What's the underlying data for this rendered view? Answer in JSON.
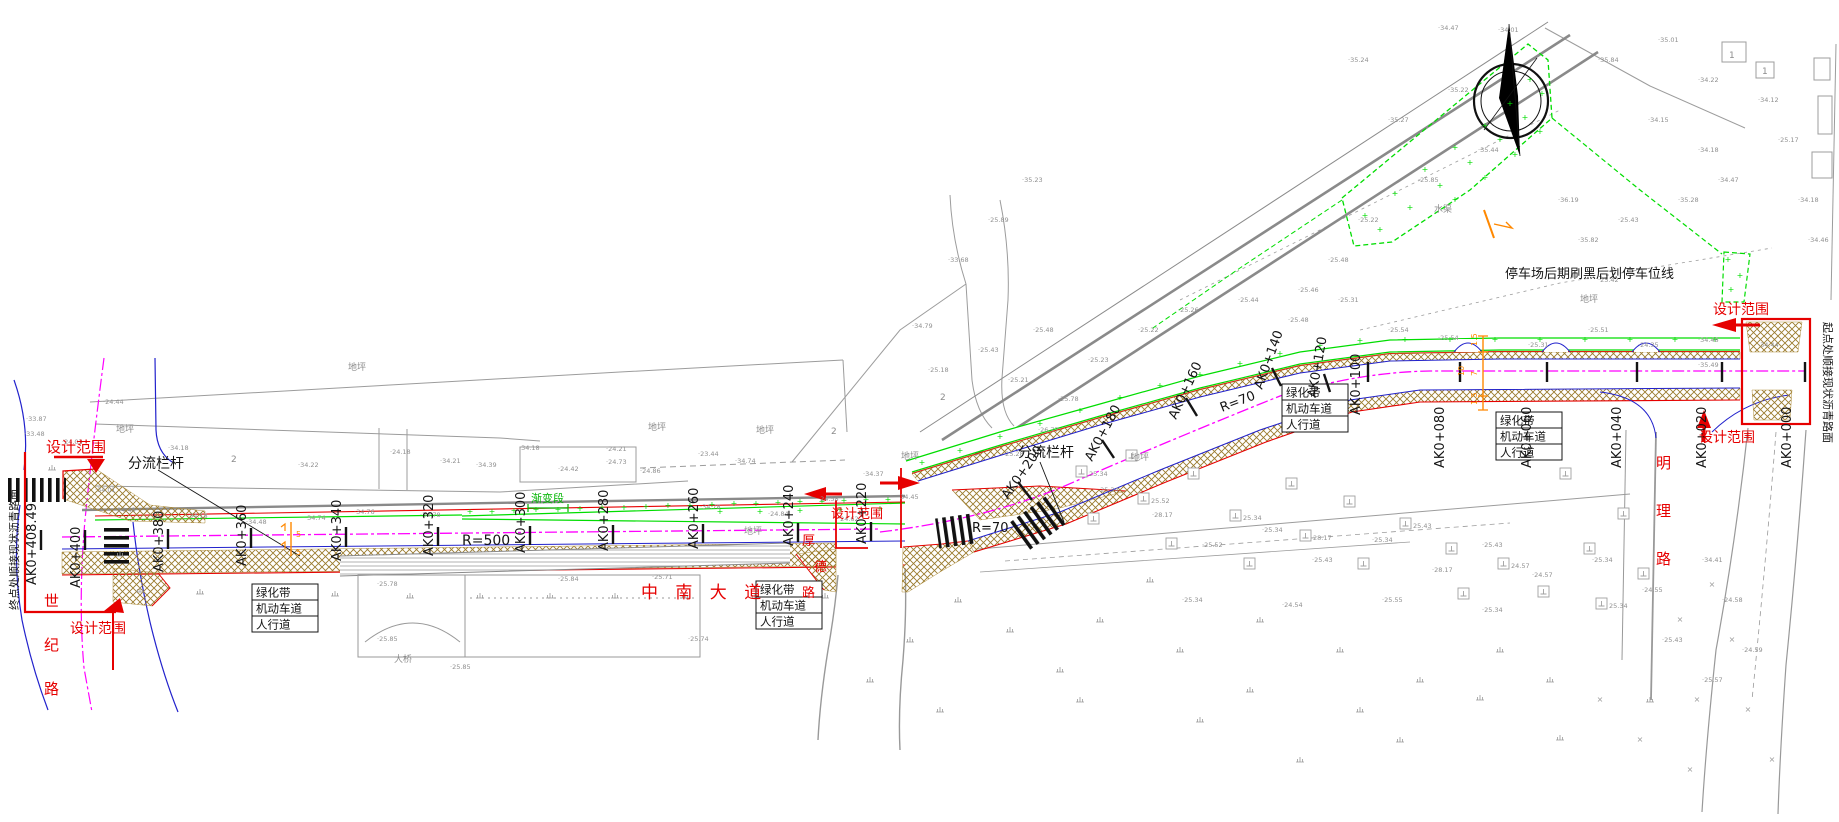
{
  "colors": {
    "red": "#e60000",
    "black": "#141414",
    "green": "#00b400",
    "bright_green": "#00dd00",
    "gray": "#8c8c8c",
    "magenta": "#ff00ff",
    "blue": "#2222cc",
    "hatch_brown": "#9a7b2d",
    "orange": "#ff8800"
  },
  "labels": {
    "red": [
      {
        "t": "设计范围",
        "x": 46,
        "y": 452,
        "s": 15,
        "n": "design-scope-label"
      },
      {
        "t": "设计范围",
        "x": 70,
        "y": 633,
        "s": 14,
        "n": "design-scope-label"
      },
      {
        "t": "设计范围",
        "x": 831,
        "y": 518,
        "s": 13,
        "n": "design-scope-label"
      },
      {
        "t": "设计范围",
        "x": 1713,
        "y": 314,
        "s": 14,
        "n": "design-scope-label"
      },
      {
        "t": "设计范围",
        "x": 1699,
        "y": 442,
        "s": 14,
        "n": "design-scope-label"
      },
      {
        "t": "中 南 大 道",
        "x": 641,
        "y": 598,
        "s": 17,
        "ls": 6,
        "n": "road-name-zhongnan-avenue"
      },
      {
        "t": "明",
        "x": 1656,
        "y": 468,
        "s": 15,
        "n": "road-name-mingli"
      },
      {
        "t": "理",
        "x": 1656,
        "y": 516,
        "s": 15,
        "n": "road-name-mingli"
      },
      {
        "t": "路",
        "x": 1656,
        "y": 564,
        "s": 15,
        "n": "road-name-mingli"
      },
      {
        "t": "世",
        "x": 44,
        "y": 606,
        "s": 15,
        "n": "road-name-shiji"
      },
      {
        "t": "纪",
        "x": 44,
        "y": 650,
        "s": 15,
        "n": "road-name-shiji"
      },
      {
        "t": "路",
        "x": 44,
        "y": 694,
        "s": 15,
        "n": "road-name-shiji"
      },
      {
        "t": "厚",
        "x": 802,
        "y": 545,
        "s": 13,
        "n": "road-name-houde"
      },
      {
        "t": "德",
        "x": 814,
        "y": 571,
        "s": 13,
        "n": "road-name-houde"
      },
      {
        "t": "路",
        "x": 802,
        "y": 597,
        "s": 13,
        "n": "road-name-houde"
      }
    ],
    "black": [
      {
        "t": "分流栏杆",
        "x": 128,
        "y": 468,
        "s": 14,
        "n": "diversion-railing-label"
      },
      {
        "t": "分流栏杆",
        "x": 1018,
        "y": 457,
        "s": 14,
        "n": "diversion-railing-label"
      },
      {
        "t": "停车场后期刷黑后划停车位线",
        "x": 1505,
        "y": 278,
        "s": 13,
        "n": "parking-note-label"
      },
      {
        "t": "起点处顺接现状沥青路面",
        "x": 1824,
        "y": 322,
        "s": 11,
        "r": 90,
        "n": "start-point-note"
      },
      {
        "t": "终点处顺接现状沥青路面",
        "x": 18,
        "y": 610,
        "s": 11,
        "r": -90,
        "n": "end-point-note"
      },
      {
        "t": "R=500",
        "x": 462,
        "y": 545,
        "s": 14,
        "n": "radius-label"
      },
      {
        "t": "R=70",
        "x": 972,
        "y": 532,
        "s": 13,
        "n": "radius-label"
      },
      {
        "t": "R=70",
        "x": 1222,
        "y": 412,
        "s": 13,
        "r": -21,
        "n": "radius-label"
      }
    ],
    "green": [
      {
        "t": "渐变段",
        "x": 531,
        "y": 502,
        "s": 11,
        "n": "transition-section-label"
      }
    ],
    "gray": [
      {
        "t": "地坪",
        "x": 116,
        "y": 432
      },
      {
        "t": "地坪",
        "x": 648,
        "y": 430
      },
      {
        "t": "地坪",
        "x": 756,
        "y": 433
      },
      {
        "t": "地坪",
        "x": 901,
        "y": 459
      },
      {
        "t": "地坪",
        "x": 1131,
        "y": 460
      },
      {
        "t": "地坪",
        "x": 1580,
        "y": 302
      },
      {
        "t": "地坪",
        "x": 744,
        "y": 534
      },
      {
        "t": "水渠",
        "x": 1434,
        "y": 212
      },
      {
        "t": "地坪",
        "x": 348,
        "y": 370
      },
      {
        "t": "大桥",
        "x": 394,
        "y": 662
      },
      {
        "t": "2",
        "x": 231,
        "y": 462
      },
      {
        "t": "2",
        "x": 831,
        "y": 434
      },
      {
        "t": "2",
        "x": 940,
        "y": 400
      },
      {
        "t": "1",
        "x": 1729,
        "y": 58
      },
      {
        "t": "1",
        "x": 1762,
        "y": 74
      }
    ]
  },
  "stations": [
    {
      "label": "AK0+408.49",
      "x": 36,
      "y": 585,
      "r": -90,
      "tick": [
        41,
        530,
        41,
        550
      ]
    },
    {
      "label": "AK0+400",
      "x": 80,
      "y": 588,
      "r": -90,
      "tick": [
        85,
        530,
        85,
        550
      ]
    },
    {
      "label": "AK0+380",
      "x": 163,
      "y": 572,
      "r": -90,
      "tick": [
        168,
        529,
        168,
        549
      ]
    },
    {
      "label": "AK0+360",
      "x": 246,
      "y": 566,
      "r": -90,
      "tick": [
        251,
        528,
        251,
        548
      ]
    },
    {
      "label": "AK0+340",
      "x": 341,
      "y": 561,
      "r": -90,
      "tick": [
        346,
        527,
        346,
        547
      ]
    },
    {
      "label": "AK0+320",
      "x": 433,
      "y": 556,
      "r": -90,
      "tick": [
        438,
        527,
        438,
        546
      ]
    },
    {
      "label": "AK0+300",
      "x": 525,
      "y": 553,
      "r": -90,
      "tick": [
        530,
        526,
        530,
        545
      ]
    },
    {
      "label": "AK0+280",
      "x": 608,
      "y": 551,
      "r": -90,
      "tick": [
        613,
        525,
        613,
        544
      ]
    },
    {
      "label": "AK0+260",
      "x": 698,
      "y": 549,
      "r": -90,
      "tick": [
        703,
        524,
        703,
        543
      ]
    },
    {
      "label": "AK0+240",
      "x": 793,
      "y": 546,
      "r": -90,
      "tick": [
        798,
        523,
        798,
        542
      ]
    },
    {
      "label": "AK0+220",
      "x": 866,
      "y": 544,
      "r": -90,
      "tick": [
        871,
        522,
        871,
        541
      ]
    },
    {
      "label": "AK0+200",
      "x": 1008,
      "y": 500,
      "r": -55,
      "tick": [
        1018,
        482,
        1032,
        500
      ]
    },
    {
      "label": "AK0+180",
      "x": 1092,
      "y": 462,
      "r": -62,
      "tick": [
        1102,
        440,
        1114,
        458
      ]
    },
    {
      "label": "AK0+160",
      "x": 1176,
      "y": 420,
      "r": -65,
      "tick": [
        1186,
        398,
        1197,
        416
      ]
    },
    {
      "label": "AK0+140",
      "x": 1262,
      "y": 390,
      "r": -70,
      "tick": [
        1272,
        368,
        1281,
        386
      ]
    },
    {
      "label": "AK0+120",
      "x": 1316,
      "y": 398,
      "r": -80,
      "tick": [
        1324,
        374,
        1330,
        392
      ]
    },
    {
      "label": "AK0+100",
      "x": 1360,
      "y": 415,
      "r": -90,
      "tick": [
        1368,
        362,
        1368,
        382
      ]
    },
    {
      "label": "AK0+080",
      "x": 1444,
      "y": 468,
      "r": -90,
      "tick": [
        1460,
        362,
        1460,
        382
      ]
    },
    {
      "label": "AK0+060",
      "x": 1531,
      "y": 468,
      "r": -90,
      "tick": [
        1547,
        362,
        1547,
        382
      ]
    },
    {
      "label": "AK0+040",
      "x": 1621,
      "y": 468,
      "r": -90,
      "tick": [
        1637,
        362,
        1637,
        382
      ]
    },
    {
      "label": "AK0+020",
      "x": 1706,
      "y": 468,
      "r": -90,
      "tick": [
        1722,
        362,
        1722,
        382
      ]
    },
    {
      "label": "AK0+000",
      "x": 1791,
      "y": 468,
      "r": -90,
      "tick": [
        1805,
        362,
        1805,
        382
      ]
    }
  ],
  "lane_boxes": {
    "rows": [
      "绿化带",
      "机动车道",
      "人行道"
    ],
    "boxes": [
      {
        "x": 252,
        "y": 584
      },
      {
        "x": 756,
        "y": 581
      },
      {
        "x": 1282,
        "y": 384
      },
      {
        "x": 1496,
        "y": 412
      }
    ]
  },
  "dim_stack": {
    "labels": [
      {
        "t": "1.5",
        "x": 1477,
        "y": 346
      },
      {
        "t": "7",
        "x": 1477,
        "y": 376
      },
      {
        "t": "1.5",
        "x": 1477,
        "y": 405
      },
      {
        "t": "10",
        "x": 1464,
        "y": 376
      }
    ]
  },
  "signals": [
    {
      "t": "5",
      "x": 296,
      "y": 537
    },
    {
      "t": "5",
      "x": 296,
      "y": 555
    }
  ],
  "elevations": [
    [
      103,
      404,
      "24.44"
    ],
    [
      62,
      444,
      "24.03"
    ],
    [
      26,
      421,
      "33.87"
    ],
    [
      24,
      436,
      "33.48"
    ],
    [
      95,
      492,
      "34.01"
    ],
    [
      115,
      512,
      "24.48"
    ],
    [
      168,
      450,
      "34.18"
    ],
    [
      187,
      518,
      "34.18"
    ],
    [
      246,
      524,
      "34.48"
    ],
    [
      305,
      520,
      "34.74"
    ],
    [
      354,
      514,
      "34.76"
    ],
    [
      420,
      517,
      "34.78"
    ],
    [
      298,
      467,
      "34.22"
    ],
    [
      390,
      454,
      "24.18"
    ],
    [
      440,
      463,
      "34.21"
    ],
    [
      476,
      467,
      "34.39"
    ],
    [
      519,
      450,
      "34.18"
    ],
    [
      558,
      471,
      "24.42"
    ],
    [
      606,
      451,
      "24.21"
    ],
    [
      606,
      464,
      "24.73"
    ],
    [
      640,
      473,
      "24.86"
    ],
    [
      698,
      456,
      "23.44"
    ],
    [
      735,
      463,
      "34.74"
    ],
    [
      700,
      509,
      "34.78"
    ],
    [
      768,
      516,
      "24.84"
    ],
    [
      818,
      501,
      "24.58"
    ],
    [
      838,
      521,
      "24.62"
    ],
    [
      863,
      476,
      "34.37"
    ],
    [
      898,
      499,
      "34.45"
    ],
    [
      377,
      586,
      "25.78"
    ],
    [
      558,
      581,
      "25.84"
    ],
    [
      652,
      579,
      "25.71"
    ],
    [
      377,
      641,
      "25.85"
    ],
    [
      688,
      641,
      "25.74"
    ],
    [
      450,
      669,
      "25.85"
    ],
    [
      1003,
      456,
      "25.28"
    ],
    [
      1038,
      432,
      "26.77"
    ],
    [
      1058,
      401,
      "25.78"
    ],
    [
      1008,
      382,
      "25.21"
    ],
    [
      978,
      352,
      "25.43"
    ],
    [
      1033,
      332,
      "25.48"
    ],
    [
      1088,
      362,
      "25.23"
    ],
    [
      1138,
      332,
      "25.22"
    ],
    [
      1178,
      312,
      "25.26"
    ],
    [
      1238,
      302,
      "25.44"
    ],
    [
      1288,
      322,
      "25.48"
    ],
    [
      1338,
      302,
      "25.31"
    ],
    [
      1388,
      332,
      "25.54"
    ],
    [
      1438,
      340,
      "25.54"
    ],
    [
      1528,
      347,
      "25.31"
    ],
    [
      1588,
      332,
      "25.51"
    ],
    [
      1638,
      347,
      "24.35"
    ],
    [
      1698,
      342,
      "34.48"
    ],
    [
      1758,
      347,
      "34.44"
    ],
    [
      1698,
      367,
      "35.49"
    ],
    [
      1098,
      492,
      "25.34"
    ],
    [
      1152,
      517,
      "28.17"
    ],
    [
      1202,
      547,
      "25.52"
    ],
    [
      1262,
      532,
      "25.34"
    ],
    [
      1312,
      562,
      "25.43"
    ],
    [
      1372,
      542,
      "25.34"
    ],
    [
      1432,
      572,
      "28.17"
    ],
    [
      1482,
      547,
      "25.43"
    ],
    [
      1532,
      577,
      "24.57"
    ],
    [
      1592,
      562,
      "25.34"
    ],
    [
      1642,
      592,
      "24.55"
    ],
    [
      1482,
      612,
      "25.34"
    ],
    [
      1382,
      602,
      "25.55"
    ],
    [
      1282,
      607,
      "24.54"
    ],
    [
      1182,
      602,
      "25.34"
    ],
    [
      1702,
      562,
      "34.41"
    ],
    [
      1722,
      602,
      "24.58"
    ],
    [
      1742,
      652,
      "24.59"
    ],
    [
      1702,
      682,
      "25.57"
    ],
    [
      1662,
      642,
      "25.43"
    ],
    [
      1388,
      122,
      "35.27"
    ],
    [
      1448,
      92,
      "35.22"
    ],
    [
      1478,
      152,
      "35.44"
    ],
    [
      1418,
      182,
      "25.85"
    ],
    [
      1358,
      222,
      "25.22"
    ],
    [
      1328,
      262,
      "25.48"
    ],
    [
      1298,
      292,
      "25.46"
    ],
    [
      1558,
      202,
      "36.19"
    ],
    [
      1578,
      242,
      "35.82"
    ],
    [
      1598,
      282,
      "25.42"
    ],
    [
      1618,
      222,
      "25.43"
    ],
    [
      1678,
      202,
      "35.28"
    ],
    [
      1698,
      152,
      "34.18"
    ],
    [
      1718,
      182,
      "34.47"
    ],
    [
      1648,
      122,
      "34.15"
    ],
    [
      1598,
      62,
      "35.84"
    ],
    [
      1658,
      42,
      "35.01"
    ],
    [
      1698,
      82,
      "34.22"
    ],
    [
      1758,
      102,
      "34.12"
    ],
    [
      1778,
      142,
      "25.17"
    ],
    [
      1798,
      202,
      "34.18"
    ],
    [
      1808,
      242,
      "34.46"
    ],
    [
      912,
      328,
      "34.79"
    ],
    [
      948,
      262,
      "33.68"
    ],
    [
      988,
      222,
      "25.89"
    ],
    [
      1022,
      182,
      "35.23"
    ],
    [
      928,
      372,
      "25.18"
    ],
    [
      1438,
      30,
      "34.47"
    ],
    [
      1348,
      62,
      "35.24"
    ],
    [
      1498,
      32,
      "34.01"
    ]
  ],
  "survey_points": [
    [
      1076,
      466,
      "25.34"
    ],
    [
      1088,
      513,
      ""
    ],
    [
      1126,
      450,
      ""
    ],
    [
      1138,
      493,
      "25.52"
    ],
    [
      1166,
      538,
      ""
    ],
    [
      1188,
      468,
      ""
    ],
    [
      1230,
      510,
      "25.34"
    ],
    [
      1244,
      558,
      ""
    ],
    [
      1286,
      478,
      ""
    ],
    [
      1300,
      530,
      "28.17"
    ],
    [
      1344,
      496,
      ""
    ],
    [
      1358,
      558,
      ""
    ],
    [
      1400,
      518,
      "25.43"
    ],
    [
      1446,
      543,
      ""
    ],
    [
      1458,
      588,
      ""
    ],
    [
      1498,
      558,
      "24.57"
    ],
    [
      1538,
      586,
      ""
    ],
    [
      1584,
      543,
      ""
    ],
    [
      1596,
      598,
      "25.34"
    ],
    [
      1638,
      568,
      ""
    ],
    [
      1560,
      468,
      ""
    ],
    [
      1618,
      508,
      ""
    ]
  ],
  "grass_marks": [
    [
      140,
      592
    ],
    [
      200,
      594
    ],
    [
      265,
      596
    ],
    [
      335,
      596
    ],
    [
      410,
      598
    ],
    [
      480,
      598
    ],
    [
      550,
      598
    ],
    [
      615,
      598
    ],
    [
      685,
      598
    ],
    [
      755,
      598
    ],
    [
      825,
      598
    ],
    [
      120,
      556
    ],
    [
      52,
      470
    ],
    [
      1100,
      622
    ],
    [
      1180,
      652
    ],
    [
      1260,
      622
    ],
    [
      1340,
      652
    ],
    [
      1420,
      682
    ],
    [
      1500,
      652
    ],
    [
      1080,
      702
    ],
    [
      1200,
      722
    ],
    [
      1300,
      762
    ],
    [
      1150,
      582
    ],
    [
      1250,
      692
    ],
    [
      1400,
      742
    ],
    [
      1550,
      682
    ],
    [
      1650,
      702
    ],
    [
      958,
      602
    ],
    [
      1010,
      632
    ],
    [
      1060,
      672
    ],
    [
      910,
      642
    ],
    [
      870,
      682
    ],
    [
      940,
      712
    ],
    [
      1480,
      700
    ],
    [
      1560,
      740
    ],
    [
      1360,
      712
    ]
  ],
  "cross_marks": [
    [
      1712,
      587
    ],
    [
      1732,
      642
    ],
    [
      1697,
      702
    ],
    [
      1748,
      712
    ],
    [
      1772,
      762
    ],
    [
      1690,
      772
    ],
    [
      1640,
      742
    ],
    [
      1600,
      702
    ],
    [
      1680,
      622
    ]
  ],
  "green_plus": [
    [
      470,
      514
    ],
    [
      492,
      514
    ],
    [
      514,
      513
    ],
    [
      536,
      512
    ],
    [
      558,
      512
    ],
    [
      580,
      511
    ],
    [
      602,
      510
    ],
    [
      624,
      510
    ],
    [
      646,
      509
    ],
    [
      668,
      508
    ],
    [
      690,
      508
    ],
    [
      712,
      507
    ],
    [
      734,
      506
    ],
    [
      756,
      506
    ],
    [
      778,
      505
    ],
    [
      800,
      504
    ],
    [
      822,
      504
    ],
    [
      844,
      503
    ],
    [
      866,
      502
    ],
    [
      888,
      502
    ],
    [
      720,
      514
    ],
    [
      760,
      514
    ],
    [
      800,
      513
    ],
    [
      840,
      512
    ],
    [
      880,
      511
    ],
    [
      922,
      465
    ],
    [
      960,
      453
    ],
    [
      1000,
      439
    ],
    [
      1040,
      426
    ],
    [
      1080,
      413
    ],
    [
      1120,
      400
    ],
    [
      1160,
      388
    ],
    [
      1200,
      377
    ],
    [
      1240,
      366
    ],
    [
      1280,
      356
    ],
    [
      1320,
      348
    ],
    [
      1360,
      343
    ],
    [
      1405,
      342
    ],
    [
      1450,
      342
    ],
    [
      1495,
      342
    ],
    [
      1540,
      342
    ],
    [
      1585,
      342
    ],
    [
      1630,
      342
    ],
    [
      1675,
      342
    ],
    [
      1715,
      342
    ],
    [
      1365,
      218
    ],
    [
      1395,
      196
    ],
    [
      1425,
      172
    ],
    [
      1455,
      150
    ],
    [
      1485,
      128
    ],
    [
      1510,
      106
    ],
    [
      1530,
      82
    ],
    [
      1380,
      232
    ],
    [
      1410,
      210
    ],
    [
      1440,
      188
    ],
    [
      1470,
      165
    ],
    [
      1500,
      142
    ],
    [
      1525,
      120
    ],
    [
      1542,
      96
    ],
    [
      1455,
      202
    ],
    [
      1485,
      180
    ],
    [
      1515,
      157
    ],
    [
      1540,
      134
    ],
    [
      1728,
      262
    ],
    [
      1740,
      278
    ],
    [
      1731,
      292
    ]
  ]
}
